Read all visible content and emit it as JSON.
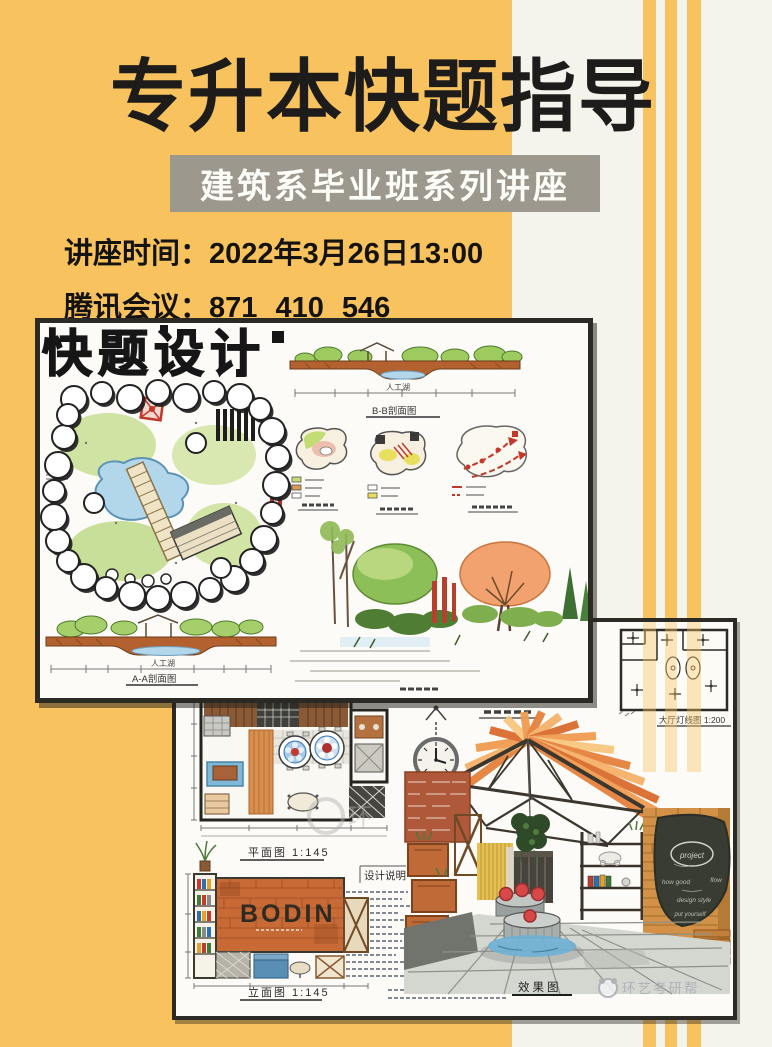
{
  "poster": {
    "title": "专升本快题指导",
    "subtitle": "建筑系毕业班系列讲座",
    "info_lines": [
      {
        "label": "讲座时间：",
        "value": "2022年3月26日13:00"
      },
      {
        "label": "腾讯会议：",
        "value": "871 410 546"
      }
    ],
    "colors": {
      "yellow": "#F8C35E",
      "offwhite": "#F5F4EC",
      "banner_gray": "#9C988E",
      "ink": "#1D1C1A"
    }
  },
  "artwork1": {
    "description": "hand-drawn landscape quick-design sheet with site plan, two sections, analysis diagrams and perspective",
    "art_title": "快题设计",
    "labels": {
      "section_bb": "B-B剖面图",
      "section_aa": "A-A剖面图",
      "lake": "人工湖"
    }
  },
  "artwork2": {
    "description": "hand-drawn interior quick-design sheet with floor plan, elevation, ceiling plan, notes and perspective",
    "sign_text": "BODIN",
    "labels": {
      "floor_plan": "平面图 1:145",
      "elevation": "立面图 1:145",
      "ceiling_plan": "大厅灯线图 1:200",
      "perspective": "效果图",
      "notes_title": "设计说明"
    },
    "chalkboard": {
      "circle_word": "project",
      "words": [
        "how good",
        "flow",
        "design style",
        "put yourself"
      ]
    },
    "watermark": "环艺考研帮",
    "watermark_partial": "环"
  }
}
